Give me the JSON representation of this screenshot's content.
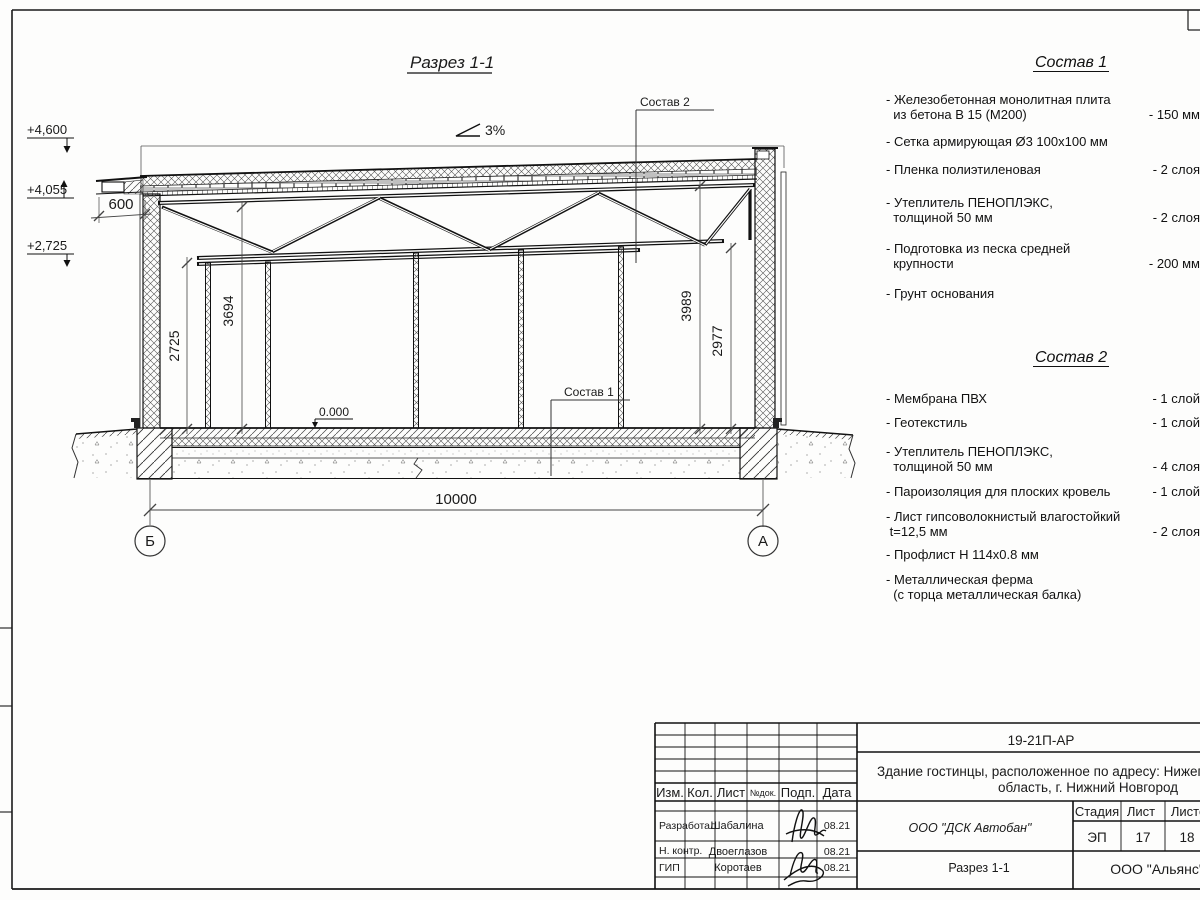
{
  "drawing": {
    "title": "Разрез 1-1",
    "slope": "3%",
    "elevations": {
      "top": "+4,600",
      "parapet": "+4,055",
      "truss": "+2,725",
      "floor": "0.000"
    },
    "dims": {
      "overhang": "600",
      "d2725": "2725",
      "d3694": "3694",
      "d3989": "3989",
      "d2977": "2977",
      "span": "10000"
    },
    "axes": {
      "left": "Б",
      "right": "А"
    }
  },
  "sostav1": {
    "title": "Состав 1",
    "items": [
      {
        "name": "- Железобетонная  монолитная плита\n  из бетона В 15 (М200)",
        "value": "- 150 мм"
      },
      {
        "name": "- Сетка армирующая Ø3 100х100 мм",
        "value": ""
      },
      {
        "name": "- Пленка полиэтиленовая",
        "value": "-  2 слоя"
      },
      {
        "name": "- Утеплитель ПЕНОПЛЭКС,\n  толщиной 50 мм",
        "value": "- 2 слоя"
      },
      {
        "name": "- Подготовка из песка средней\n  крупности",
        "value": "- 200 мм"
      },
      {
        "name": "- Грунт основания",
        "value": ""
      }
    ]
  },
  "sostav2": {
    "title": "Состав 2",
    "items": [
      {
        "name": "- Мембрана ПВХ",
        "value": "- 1 слой"
      },
      {
        "name": "- Геотекстиль",
        "value": "- 1 слой"
      },
      {
        "name": "- Утеплитель ПЕНОПЛЭКС,\n  толщиной 50 мм",
        "value": "- 4 слоя"
      },
      {
        "name": "- Пароизоляция для плоских кровель",
        "value": "- 1 слой"
      },
      {
        "name": "- Лист гипсоволокнистый влагостойкий\n t=12,5 мм",
        "value": "- 2 слоя"
      },
      {
        "name": "- Профлист Н 114х0.8 мм",
        "value": ""
      },
      {
        "name": "- Металлическая ферма\n  (с торца металлическая балка)",
        "value": ""
      }
    ]
  },
  "titleblock": {
    "doc_code": "19-21П-АР",
    "project_line1": "Здание гостинцы, расположенное по адресу: Нижегородская",
    "project_line2": "область, г. Нижний Новгород",
    "cols": {
      "izm": "Изм.",
      "kol": "Кол.",
      "list": "Лист",
      "ndok": "№док.",
      "podp": "Подп.",
      "data": "Дата"
    },
    "rows": [
      {
        "role": "Разработал",
        "name": "Шабалина",
        "date": "08.21"
      },
      {
        "role": "Н. контр.",
        "name": "Двоеглазов",
        "date": "08.21"
      },
      {
        "role": "ГИП",
        "name": "Коротаев",
        "date": "08.21"
      }
    ],
    "company": "ООО \"ДСК Автобан\"",
    "stage_label": "Стадия",
    "sheet_label": "Лист",
    "sheets_label": "Листов",
    "stage": "ЭП",
    "sheet": "17",
    "sheets": "18",
    "drawing_name": "Разрез 1-1",
    "org": "ООО \"Альянс\""
  }
}
